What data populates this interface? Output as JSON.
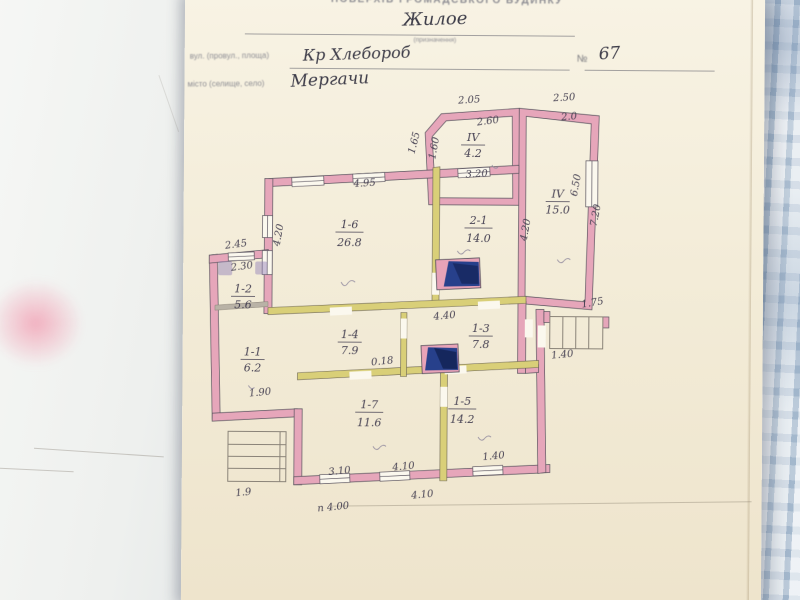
{
  "photo": {
    "background": "blue-checkered-fabric",
    "colors": {
      "fabric": "#c7d4e0",
      "paper_cream": "#f3ecd8",
      "wall_pink": "#e6a6ba",
      "partition_yellow": "#d9cf78",
      "stove_blue": "#27408b",
      "smudge_pink": "#f18ca5"
    }
  },
  "document": {
    "printed_title": "ПОВЕРХІВ ГРОМАДСЬКОГО БУДИНКУ",
    "purpose_value": "Жилое",
    "purpose_caption": "(призначення)",
    "street_label": "вул. (провул., площа)",
    "street_value": "Кр Хлебороб",
    "number_label": "№",
    "number_value": "67",
    "city_label": "місто (селище, село)",
    "city_value": "Мергачи"
  },
  "plan": {
    "rooms": [
      {
        "id": "IV",
        "area": "4.2"
      },
      {
        "id": "IV",
        "area": "15.0"
      },
      {
        "id": "1-6",
        "area": "26.8"
      },
      {
        "id": "2-1",
        "area": "14.0"
      },
      {
        "id": "1-2",
        "area": "5.6"
      },
      {
        "id": "1-1",
        "area": "6.2"
      },
      {
        "id": "1-4",
        "area": "7.9"
      },
      {
        "id": "1-3",
        "area": "7.8"
      },
      {
        "id": "1-7",
        "area": "11.6"
      },
      {
        "id": "1-5",
        "area": "14.2"
      }
    ],
    "dims": [
      "2.05",
      "2.50",
      "1.65",
      "1.60",
      "2.60",
      "2.0",
      "6.50",
      "7.20",
      "4.95",
      "3.20",
      "4.20",
      "4.20",
      "2.45",
      "2.30",
      "4.40",
      "0.18",
      "1.90",
      "1.75",
      "1.40",
      "1.40",
      "3.10",
      "4.10",
      "1.9",
      "п 4.00",
      "4.10"
    ]
  }
}
